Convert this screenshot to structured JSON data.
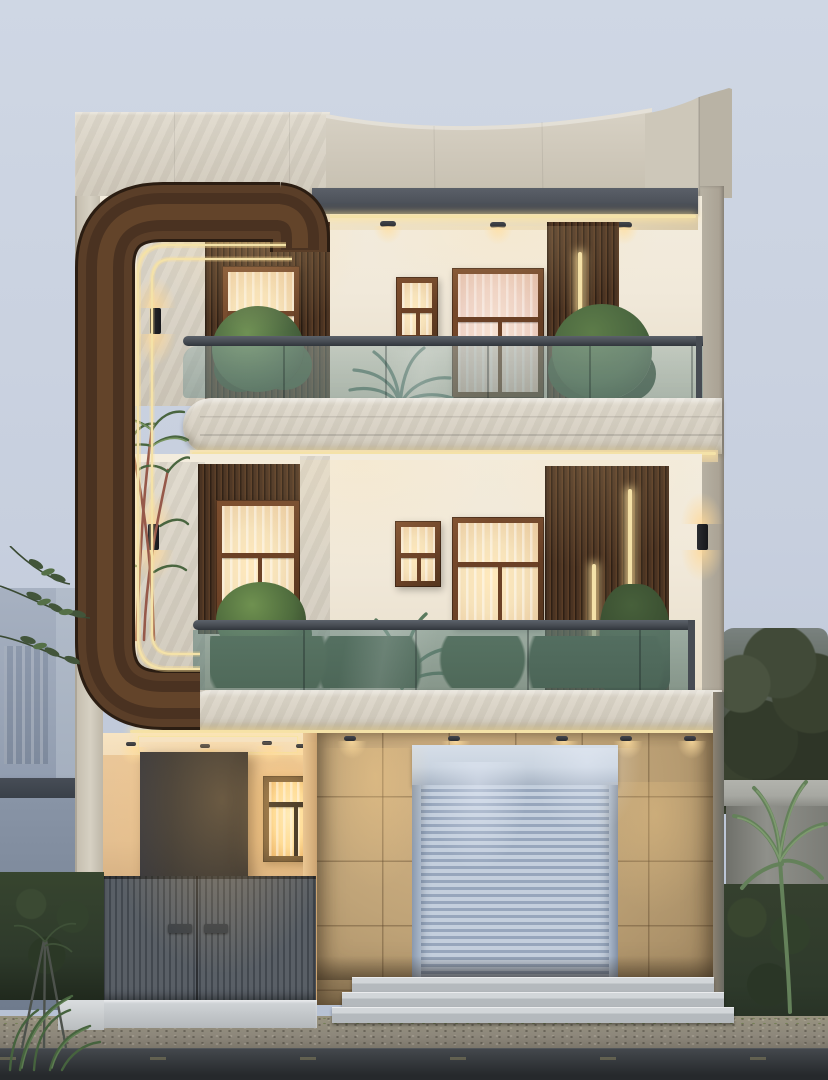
{
  "scene": {
    "type": "architectural-exterior-render",
    "subject": "modern three-storey house front elevation at dusk",
    "floors": 3,
    "objects": [
      "curved-wood-accent-frame",
      "marble-parapet",
      "gray-fascia-band",
      "recessed-downlights",
      "led-strip-lights",
      "wall-sconces",
      "wood-slat-panels",
      "curtained-windows",
      "glass-balcony-railings",
      "balcony-plants",
      "areca-palm",
      "rolling-shutter-garage",
      "tan-tile-ground-wall",
      "entry-porch",
      "dark-entry-door",
      "metal-slat-gate",
      "entry-steps",
      "driveway-apron",
      "neighbor-building",
      "boundary-wall",
      "hedges",
      "trees",
      "road"
    ]
  },
  "palette": {
    "sky_top": "#cfd7e4",
    "sky_bottom": "#b5c0d3",
    "marble_light": "#e0dacd",
    "marble_mid": "#cfc8ba",
    "marble_dark": "#b3ac9e",
    "fascia": "#4d525a",
    "wood_dark": "#3a281a",
    "wood_mid": "#5a3e28",
    "wood_light": "#6b4a2e",
    "led_gold": "#f4e2a8",
    "wall_cream": "#f1e9da",
    "ceiling_warm": "#efe3c9",
    "frame_brown": "#6b4126",
    "curtain_warm": "#f6e2ba",
    "curtain_pink": "#eed2c5",
    "porch_window_glow": "#ffdf9b",
    "glass_top": "rgba(150,174,171,0.5)",
    "glass_mid": "rgba(106,137,131,0.62)",
    "rail_gray": "#474c53",
    "slat_dark": "#2e1f14",
    "slat_mid": "#4a3322",
    "slat_light": "#5a3d26",
    "tile_tan": "#c0a478",
    "tile_line": "rgba(90,68,42,0.4)",
    "shutter_light": "#c4cfdd",
    "shutter_dark": "#97a6bc",
    "shutter_header": "#cad4e0",
    "porch_wall": "#e4bf90",
    "porch_ceiling": "#f4debb",
    "door_dark": "#2a2b2e",
    "gate_mid": "#595f66",
    "gate_dark": "#42484f",
    "step_top": "#d2d6d9",
    "step_face": "#b4b9bd",
    "gravel": "#8d877b",
    "road_top": "#3a3e42",
    "road_bottom": "#26292c",
    "neighbor_light": "#a7b1c1",
    "neighbor_mid": "#8f9bae",
    "neighbor_dark": "#78849a",
    "canopy_dark": "#394049",
    "wallr_cap": "#a7a8a2",
    "wallr_body": "#8f908a",
    "leaf_dark": "#2e3a2b",
    "leaf_mid": "#49653f",
    "leaf_light": "#6f9154",
    "palm_green": "#64815a",
    "stem_red": "#96594a",
    "glow_warm": "rgba(255,216,150,0.8)"
  }
}
